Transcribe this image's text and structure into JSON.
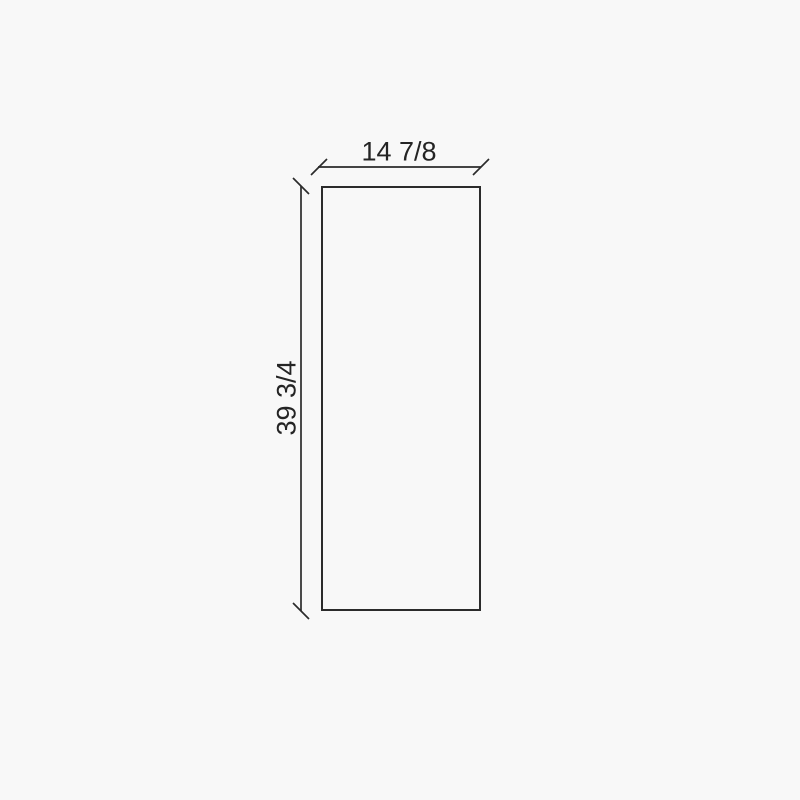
{
  "diagram": {
    "type": "technical-dimension-drawing",
    "panel": {
      "width_label": "14 7/8",
      "height_label": "39 3/4",
      "width_value": 14.875,
      "height_value": 39.75,
      "units": "inches"
    }
  },
  "colors": {
    "background": "#f8f8f8",
    "line": "#2b2b2b",
    "text": "#242424"
  }
}
